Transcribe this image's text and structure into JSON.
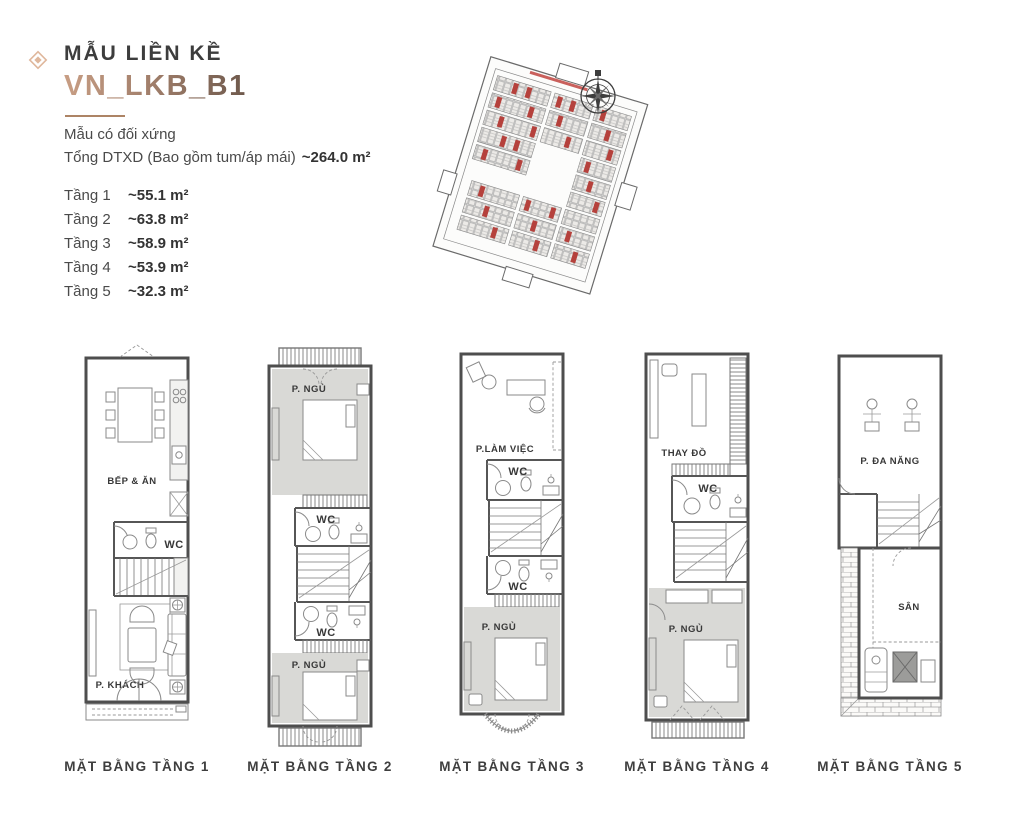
{
  "header": {
    "title": "MẪU LIỀN KỀ",
    "model_code": "VN_LKB_B1",
    "symmetry_note": "Mẫu có đối xứng",
    "total_area_label": "Tổng DTXD (Bao gồm tum/áp mái)",
    "total_area_value": "~264.0 m²"
  },
  "floor_areas": [
    {
      "label": "Tầng 1",
      "value": "~55.1 m²"
    },
    {
      "label": "Tầng 2",
      "value": "~63.8 m²"
    },
    {
      "label": "Tầng 3",
      "value": "~58.9 m²"
    },
    {
      "label": "Tầng 4",
      "value": "~53.9 m²"
    },
    {
      "label": "Tầng 5",
      "value": "~32.3 m²"
    }
  ],
  "site_map": {
    "highlight_color": "#b5413c",
    "compass_icon": "compass-rose"
  },
  "floor_plans": [
    {
      "name": "MẶT BẰNG TẦNG 1",
      "rooms": [
        "BẾP & ĂN",
        "WC",
        "P. KHÁCH"
      ]
    },
    {
      "name": "MẶT BẰNG TẦNG 2",
      "rooms": [
        "P. NGỦ",
        "WC",
        "WC",
        "P. NGỦ"
      ]
    },
    {
      "name": "MẶT BẰNG TẦNG 3",
      "rooms": [
        "P.LÀM VIỆC",
        "WC",
        "WC",
        "P. NGỦ"
      ]
    },
    {
      "name": "MẶT BẰNG TẦNG 4",
      "rooms": [
        "THAY ĐỒ",
        "WC",
        "P. NGỦ"
      ]
    },
    {
      "name": "MẶT BẰNG TẦNG 5",
      "rooms": [
        "P. ĐA NĂNG",
        "SÂN"
      ]
    }
  ],
  "colors": {
    "accent_brown": "#a3806c",
    "accent_tan": "#dfb79c",
    "room_gray": "#d9d9d6",
    "wall_gray": "#4e4e4e",
    "text_dark": "#3d3d3d"
  }
}
